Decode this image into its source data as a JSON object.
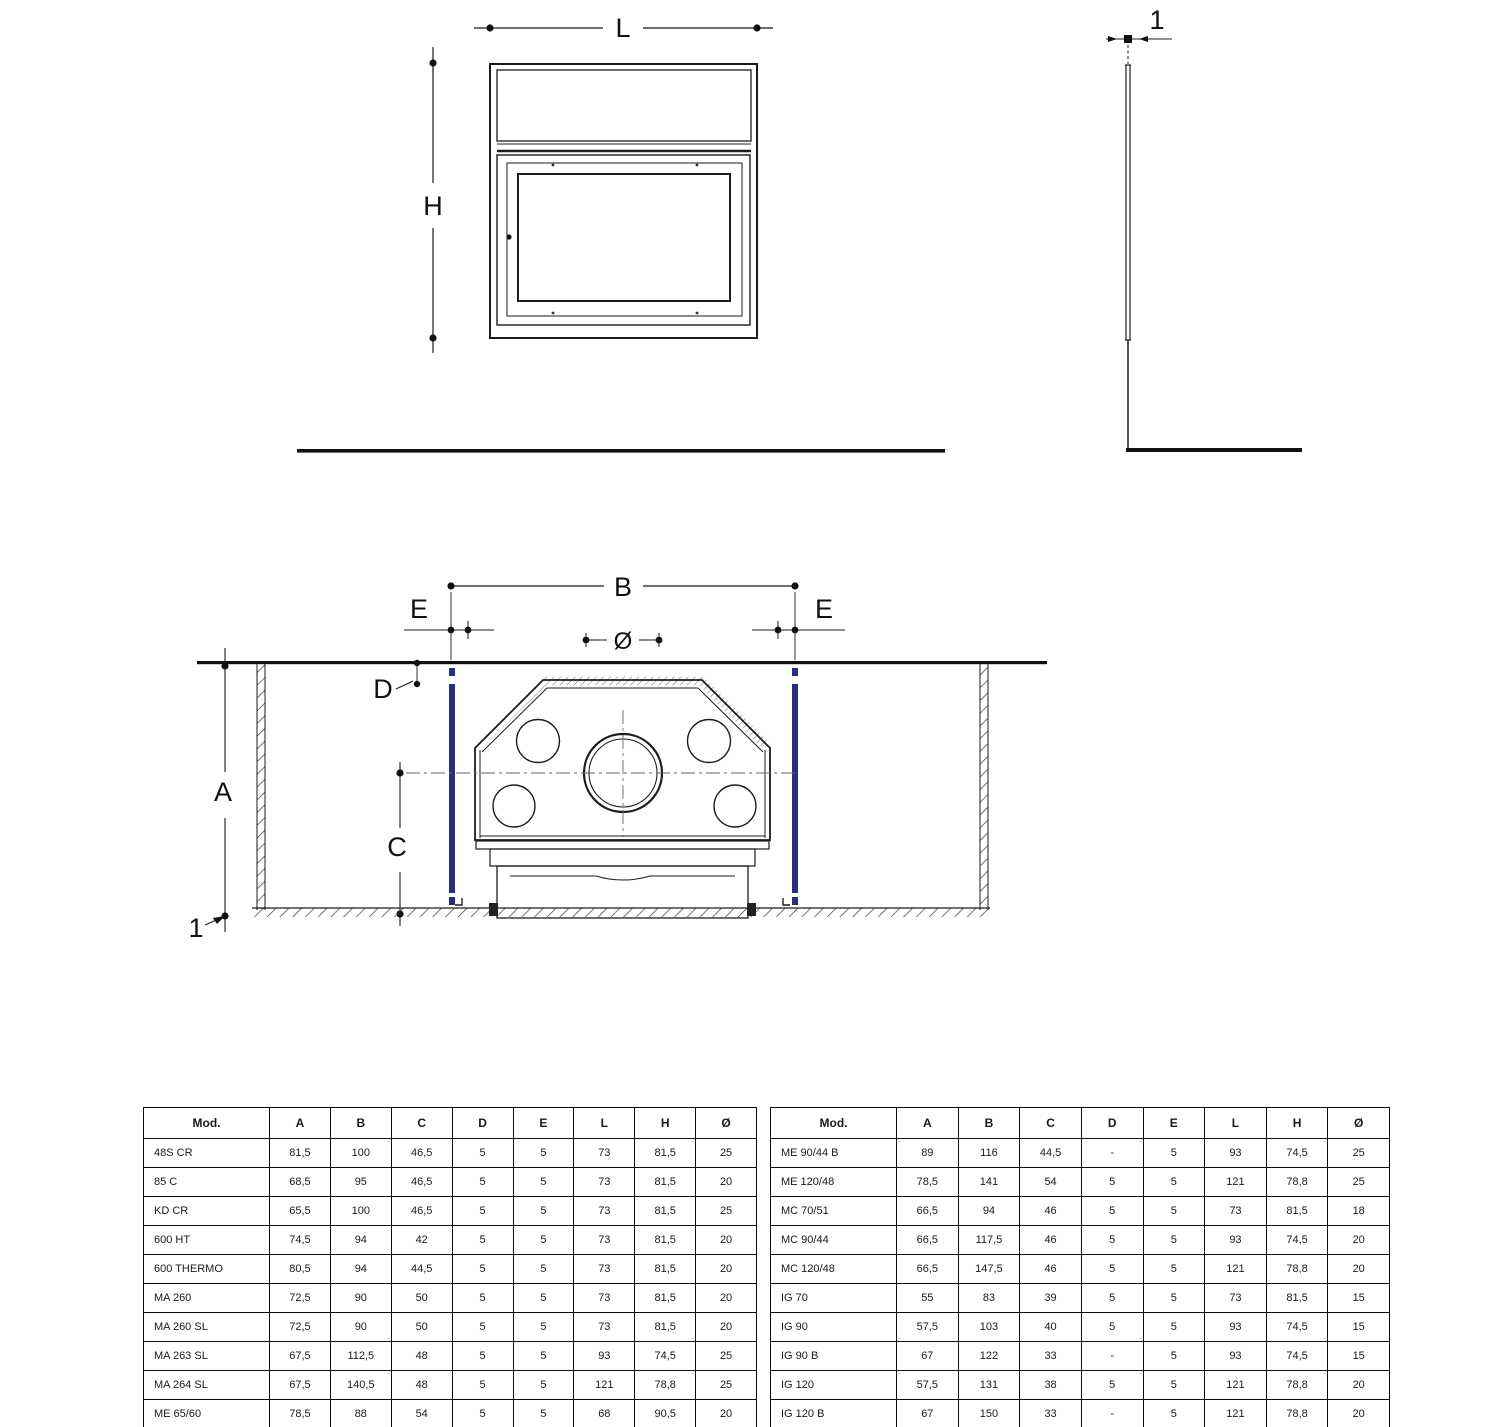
{
  "drawing": {
    "front_view": {
      "width_label": "L",
      "height_label": "H"
    },
    "side_view": {
      "thickness_label": "1"
    },
    "section_view": {
      "width_label": "B",
      "edge_left_label": "E",
      "edge_right_label": "E",
      "flue_label": "Ø",
      "depth_label": "D",
      "height_label": "A",
      "inner_height_label": "C",
      "ref_label": "1"
    }
  },
  "colors": {
    "insulation_bar": "#2b2b80"
  },
  "tables": {
    "headers": [
      "Mod.",
      "A",
      "B",
      "C",
      "D",
      "E",
      "L",
      "H",
      "Ø"
    ],
    "left_rows": [
      [
        "48S CR",
        "81,5",
        "100",
        "46,5",
        "5",
        "5",
        "73",
        "81,5",
        "25"
      ],
      [
        "85 C",
        "68,5",
        "95",
        "46,5",
        "5",
        "5",
        "73",
        "81,5",
        "20"
      ],
      [
        "KD CR",
        "65,5",
        "100",
        "46,5",
        "5",
        "5",
        "73",
        "81,5",
        "25"
      ],
      [
        "600 HT",
        "74,5",
        "94",
        "42",
        "5",
        "5",
        "73",
        "81,5",
        "20"
      ],
      [
        "600 THERMO",
        "80,5",
        "94",
        "44,5",
        "5",
        "5",
        "73",
        "81,5",
        "20"
      ],
      [
        "MA 260",
        "72,5",
        "90",
        "50",
        "5",
        "5",
        "73",
        "81,5",
        "20"
      ],
      [
        "MA 260 SL",
        "72,5",
        "90",
        "50",
        "5",
        "5",
        "73",
        "81,5",
        "20"
      ],
      [
        "MA 263 SL",
        "67,5",
        "112,5",
        "48",
        "5",
        "5",
        "93",
        "74,5",
        "25"
      ],
      [
        "MA 264 SL",
        "67,5",
        "140,5",
        "48",
        "5",
        "5",
        "121",
        "78,8",
        "25"
      ],
      [
        "ME 65/60",
        "78,5",
        "88",
        "54",
        "5",
        "5",
        "68",
        "90,5",
        "20"
      ],
      [
        "ME 70/51",
        "73,5",
        "93",
        "51",
        "5",
        "5",
        "73",
        "81,5",
        "20"
      ]
    ],
    "right_rows": [
      [
        "ME 90/44 B",
        "89",
        "116",
        "44,5",
        "-",
        "5",
        "93",
        "74,5",
        "25"
      ],
      [
        "ME 120/48",
        "78,5",
        "141",
        "54",
        "5",
        "5",
        "121",
        "78,8",
        "25"
      ],
      [
        "MC 70/51",
        "66,5",
        "94",
        "46",
        "5",
        "5",
        "73",
        "81,5",
        "18"
      ],
      [
        "MC 90/44",
        "66,5",
        "117,5",
        "46",
        "5",
        "5",
        "93",
        "74,5",
        "20"
      ],
      [
        "MC 120/48",
        "66,5",
        "147,5",
        "46",
        "5",
        "5",
        "121",
        "78,8",
        "20"
      ],
      [
        "IG 70",
        "55",
        "83",
        "39",
        "5",
        "5",
        "73",
        "81,5",
        "15"
      ],
      [
        "IG 90",
        "57,5",
        "103",
        "40",
        "5",
        "5",
        "93",
        "74,5",
        "15"
      ],
      [
        "IG 90 B",
        "67",
        "122",
        "33",
        "-",
        "5",
        "93",
        "74,5",
        "15"
      ],
      [
        "IG 120",
        "57,5",
        "131",
        "38",
        "5",
        "5",
        "121",
        "78,8",
        "20"
      ],
      [
        "IG 120 B",
        "67",
        "150",
        "33",
        "-",
        "5",
        "121",
        "78,8",
        "20"
      ],
      [
        "MB 270",
        "76 / 87,4",
        "106",
        "33 / 57,4",
        "5",
        "5",
        "66",
        "90,5",
        "9"
      ]
    ]
  }
}
